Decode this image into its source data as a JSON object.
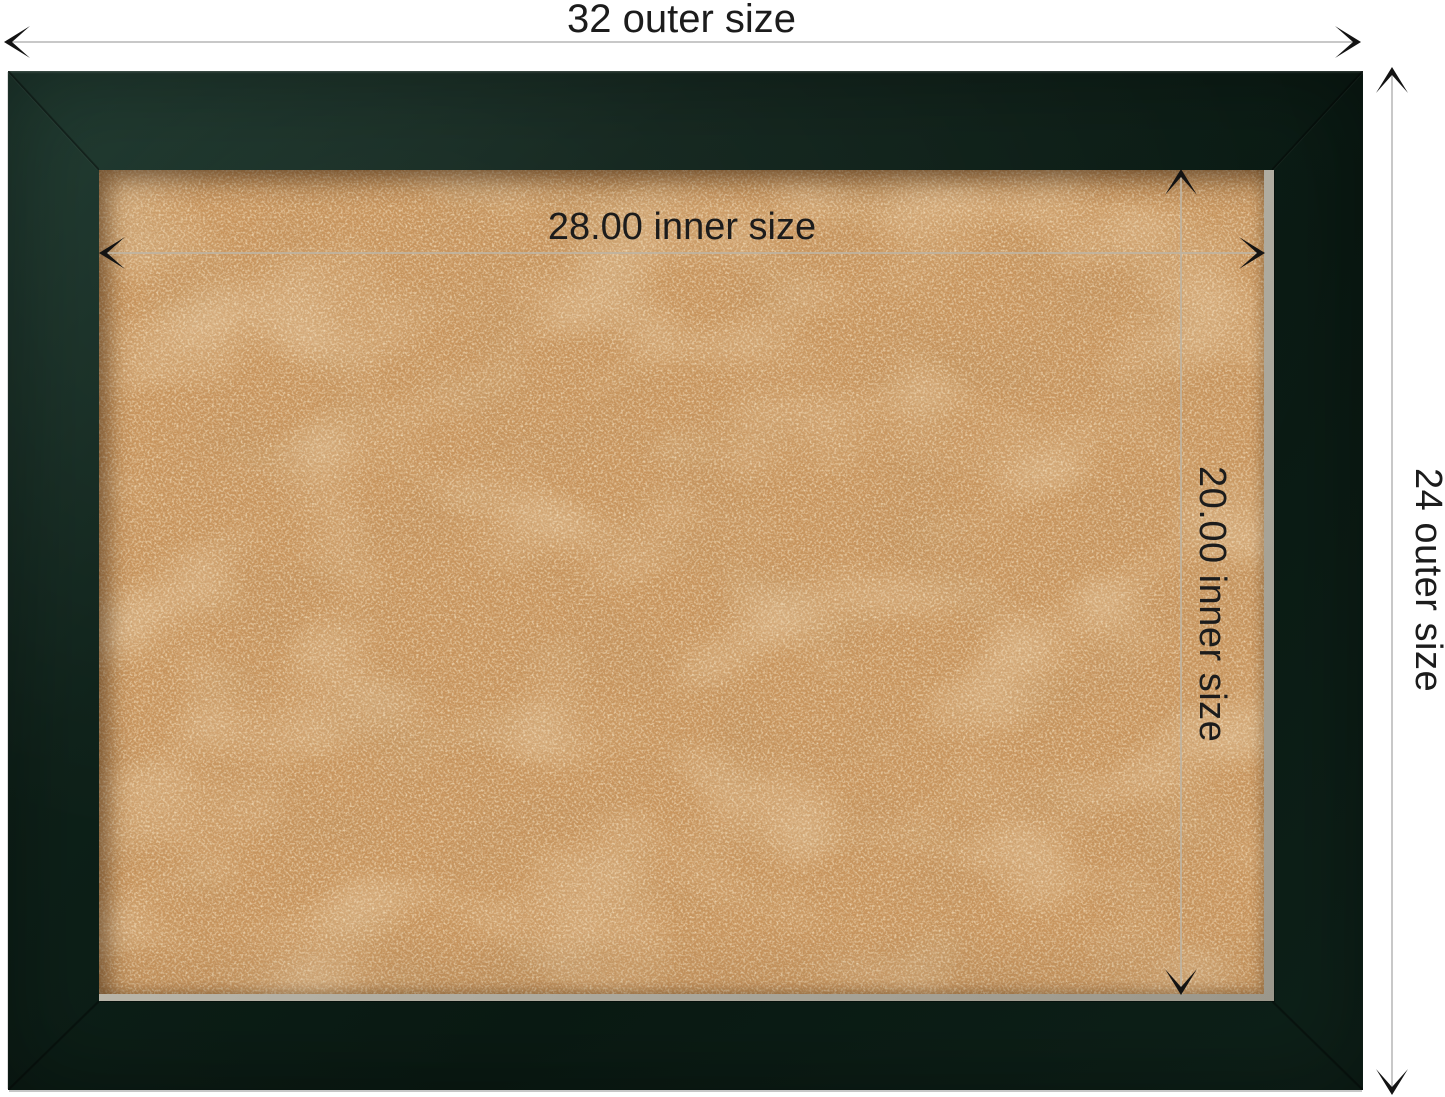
{
  "labels": {
    "outer_width": "32 outer size",
    "outer_height": "24 outer size",
    "inner_width": "28.00 inner size",
    "inner_height": "20.00 inner size"
  },
  "colors": {
    "page-bg": "#ffffff",
    "text": "#1c1c1c",
    "frame": "#0e2119",
    "frame-hi": "#1a362b",
    "frame-lo": "#0a1a13",
    "cork": "#c8955e",
    "lip": "#b7b3a7",
    "outer-line": "#c8c8c8",
    "inner-line": "#beb4a2",
    "arrow": "#131313"
  }
}
